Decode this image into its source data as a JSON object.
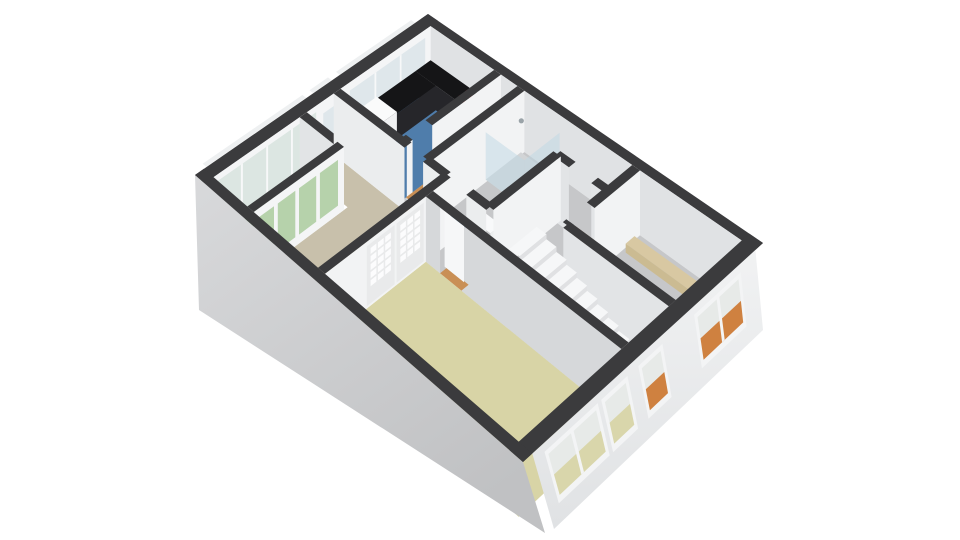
{
  "scene": {
    "type": "floor-plan-3d",
    "palette": {
      "background": "#ffffff",
      "wallTop": "#3b3b3d",
      "faceU": "#f2f3f4",
      "faceV": "#e2e4e6",
      "neInner": "#e0e2e4",
      "nwInner": "#f4f5f6",
      "frame": "#eef0f1",
      "glass": "#dfe7eb",
      "glassBalcony": "#dce6e2",
      "glassGreen": "#b6d2ab",
      "floorGray": "#c6c7c9",
      "kitchenBlue": "#4f7dab",
      "bedroomTan": "#c8c0ab",
      "livingKhaki": "#d8d4a6",
      "balconyGreen": "#5ba24e",
      "wood": "#c98f55",
      "counter": "#151517",
      "counterFace": "#26262a",
      "burnerRed": "#c62828",
      "burnerDark": "#431112",
      "stairTread": "#f6f7f8",
      "stairRiser": "#e0e1e3",
      "stringer": "#e8eaec",
      "rail": "#2c2c2e",
      "showerGlass": "rgba(190,215,228,0.5)",
      "tubBlue": "#6f9cc0",
      "sillKhaki": "#d9d6ab",
      "sillOrange": "#cf8140",
      "doorLeaf": "#f6f7f8",
      "ensuiteLeaf": "#e9eaeb",
      "ensuitePane": "#fcfcfd",
      "extSwTop": "#d8d9db",
      "extSwBottom": "#c0c1c3",
      "extSeTop": "#f1f2f3",
      "extSeBottom": "#e0e2e4"
    },
    "projection": {
      "a": 220.95,
      "b": -250.17,
      "c": 428,
      "d": 192.68,
      "e": 145.59,
      "f": 14,
      "g": -0.149475,
      "h": -0.08803,
      "drop": 58,
      "sw_bottom": [
        [
          199,
          310
        ],
        [
          545,
          533
        ]
      ],
      "se_bottom": [
        [
          554,
          529
        ],
        [
          763,
          330
        ]
      ]
    },
    "rooms": [
      {
        "name": "hall-zone",
        "color_key": "floorGray",
        "poly": [
          [
            0.249,
            0.035
          ],
          [
            0.965,
            0.035
          ],
          [
            0.965,
            0.56
          ],
          [
            0.249,
            0.56
          ]
        ]
      },
      {
        "name": "kitchen",
        "color_key": "kitchenBlue",
        "poly": [
          [
            0.035,
            0.035
          ],
          [
            0.249,
            0.035
          ],
          [
            0.249,
            0.44
          ],
          [
            0.035,
            0.44
          ]
        ]
      },
      {
        "name": "bedroom",
        "color_key": "bedroomTan",
        "poly": [
          [
            0.035,
            0.47
          ],
          [
            0.389,
            0.47
          ],
          [
            0.389,
            0.965
          ],
          [
            0.176,
            0.965
          ],
          [
            0.176,
            0.585
          ],
          [
            0.035,
            0.585
          ]
        ]
      },
      {
        "name": "balcony",
        "color_key": "balconyGreen",
        "poly": [
          [
            0.035,
            0.615
          ],
          [
            0.154,
            0.615
          ],
          [
            0.154,
            0.965
          ],
          [
            0.035,
            0.965
          ]
        ]
      },
      {
        "name": "living-room",
        "color_key": "livingKhaki",
        "poly": [
          [
            0.411,
            0.56
          ],
          [
            0.965,
            0.56
          ],
          [
            0.965,
            0.965
          ],
          [
            0.411,
            0.965
          ]
        ]
      },
      {
        "name": "vestibule",
        "color_key": "wood",
        "poly": [
          [
            0.935,
            0.385
          ],
          [
            0.965,
            0.385
          ],
          [
            0.965,
            0.545
          ],
          [
            0.935,
            0.545
          ]
        ]
      }
    ],
    "nw_band": {
      "outer_bands": [
        [
          0.06,
          0.4
        ],
        [
          0.435,
          0.515
        ],
        [
          0.545,
          0.955
        ]
      ],
      "kitchen_window": {
        "v": [
          0.06,
          0.4
        ],
        "glass": [
          8,
          44
        ],
        "mullions": [
          0.173,
          0.287
        ]
      },
      "pier_window": {
        "v": [
          0.435,
          0.515
        ],
        "glass": [
          12,
          46
        ],
        "mullions": []
      },
      "balcony_glazing": {
        "v": [
          0.545,
          0.955
        ],
        "glass": [
          6,
          52
        ],
        "mullions": [
          0.6475,
          0.75,
          0.8525
        ]
      }
    },
    "walls": [
      {
        "name": "kitchen-se",
        "axis": "u",
        "c": 0.26,
        "from": 0.035,
        "to": 0.455,
        "gaps": [
          [
            0.345,
            0.43
          ]
        ]
      },
      {
        "name": "bathroom-nw",
        "axis": "u",
        "c": 0.335,
        "from": 0.035,
        "to": 0.455,
        "gaps": []
      },
      {
        "name": "balcony-bedroom-ne",
        "axis": "v",
        "c": 0.6,
        "from": 0.035,
        "to": 0.165,
        "gaps": []
      },
      {
        "name": "kitchen-bedroom",
        "axis": "v",
        "c": 0.455,
        "from": 0.035,
        "to": 0.53,
        "gaps": [
          [
            0.275,
            0.335
          ],
          [
            0.4,
            0.47
          ]
        ],
        "face": "#ebedee"
      },
      {
        "name": "toilet-sw",
        "axis": "v",
        "c": 0.16,
        "from": 0.53,
        "to": 0.68,
        "gaps": [
          [
            0.575,
            0.64
          ]
        ]
      },
      {
        "name": "bathroom-se",
        "axis": "u",
        "c": 0.53,
        "from": 0.16,
        "to": 0.455,
        "gaps": []
      },
      {
        "name": "balcony-doors",
        "axis": "u",
        "c": 0.165,
        "from": 0.6,
        "to": 0.965,
        "type": "glazed",
        "panes": [
          [
            0.625,
            0.7
          ],
          [
            0.715,
            0.785
          ],
          [
            0.8,
            0.87
          ],
          [
            0.885,
            0.945
          ]
        ]
      },
      {
        "name": "east-room-nw",
        "axis": "u",
        "c": 0.68,
        "from": 0.035,
        "to": 0.345,
        "gaps": [
          [
            0.24,
            0.33
          ]
        ]
      },
      {
        "name": "east-room-sw",
        "axis": "v",
        "c": 0.345,
        "from": 0.68,
        "to": 0.965,
        "gaps": []
      },
      {
        "name": "ensuite-doors",
        "axis": "u",
        "c": 0.4,
        "from": 0.455,
        "to": 0.965,
        "type": "ensuite",
        "doors": [
          0.565,
          0.805
        ]
      },
      {
        "name": "living-ne",
        "axis": "v",
        "c": 0.545,
        "from": 0.411,
        "to": 0.965,
        "gaps": [
          [
            0.455,
            0.52
          ]
        ],
        "top_full": true,
        "door_leaf": [
          0.458,
          0.517
        ],
        "face": "#d6d8da"
      }
    ],
    "kitchen_features": {
      "counter_ne": [
        0.035,
        0.035,
        0.249,
        0.105
      ],
      "counter_nw": [
        0.035,
        0.105,
        0.105,
        0.455
      ],
      "counter_lift": 34,
      "sink_unit": [
        0.038,
        0.285,
        0.108,
        0.415
      ],
      "sink_lift": 31,
      "burners": {
        "u": [
          0.18,
          0.222
        ],
        "v": [
          0.057,
          0.088
        ],
        "r": 4.2,
        "ri": 1.8
      }
    },
    "bathroom_features": {
      "shower_tray": [
        0.345,
        0.05,
        0.465,
        0.21
      ],
      "shower_glass_lift": [
        12,
        56
      ],
      "shower_head": [
        0.36,
        0.07,
        20
      ],
      "tub_strip": [
        0.345,
        0.42,
        0.5,
        0.445
      ],
      "tub_lift": 40,
      "wash_basin": [
        0.47,
        0.4,
        0.525,
        0.445
      ],
      "basin_lift": 26,
      "toilet_pos": [
        0.605,
        0.095
      ]
    },
    "east_strip": {
      "rect": [
        0.7,
        0.075,
        0.945,
        0.115
      ],
      "lift": 50,
      "color": "#d8c8a2",
      "face_color": "#cbbb92"
    },
    "stairs": {
      "u_top": 0.62,
      "u_bottom": 0.935,
      "v0": 0.385,
      "v1": 0.5,
      "steps": 11,
      "top_lift": 8.5,
      "step_drop": 4.45,
      "stringer_v": 0.503,
      "rail": {
        "from": [
          0.945,
          0.507,
          20
        ],
        "to": [
          0.625,
          0.507,
          -28
        ]
      }
    },
    "se_windows": [
      {
        "name": "living-window-1",
        "q": [
          0.045,
          0.285
        ],
        "sill_key": "sillKhaki",
        "sections": 2
      },
      {
        "name": "living-window-2",
        "q": [
          0.301,
          0.419
        ],
        "sill_key": "sillKhaki",
        "sections": 1
      },
      {
        "name": "hall-window",
        "q": [
          0.468,
          0.577
        ],
        "sill_key": "sillOrange",
        "sections": 1
      },
      {
        "name": "east-room-window",
        "q": [
          0.72,
          0.93
        ],
        "sill_key": "sillOrange",
        "sections": 2
      }
    ],
    "se_window_style": {
      "f_top": 0.1,
      "f_bottom": 0.78,
      "g_top": 0.16,
      "g_split": 0.43,
      "g_bottom": 0.7
    }
  }
}
